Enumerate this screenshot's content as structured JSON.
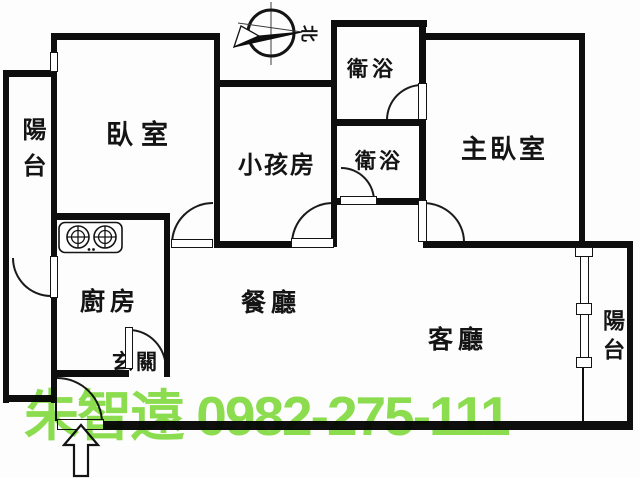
{
  "rooms": {
    "balcony_left": {
      "label": "陽台"
    },
    "bedroom": {
      "label": "臥室"
    },
    "kids_room": {
      "label": "小孩房"
    },
    "bathroom_upper": {
      "label": "衛浴"
    },
    "bathroom_lower": {
      "label": "衛浴"
    },
    "master_bedroom": {
      "label": "主臥室"
    },
    "kitchen": {
      "label": "廚房"
    },
    "dining": {
      "label": "餐廳"
    },
    "living": {
      "label": "客廳"
    },
    "entry": {
      "label": "玄關"
    },
    "balcony_right": {
      "label": "陽台"
    }
  },
  "compass": {
    "north_label": "北"
  },
  "watermark": {
    "agent_name": "朱智遠",
    "phone": "0982-275-111",
    "color": "#8CDE4E"
  },
  "colors": {
    "wall": "#0e0e0e",
    "background": "#fdfdfd",
    "watermark_green": "#8CDE4E"
  },
  "icons": {
    "compass": "compass-north-icon",
    "stove": "two-burner-stove-icon",
    "entrance_arrow": "entrance-arrow-icon",
    "window": "window-symbol"
  }
}
